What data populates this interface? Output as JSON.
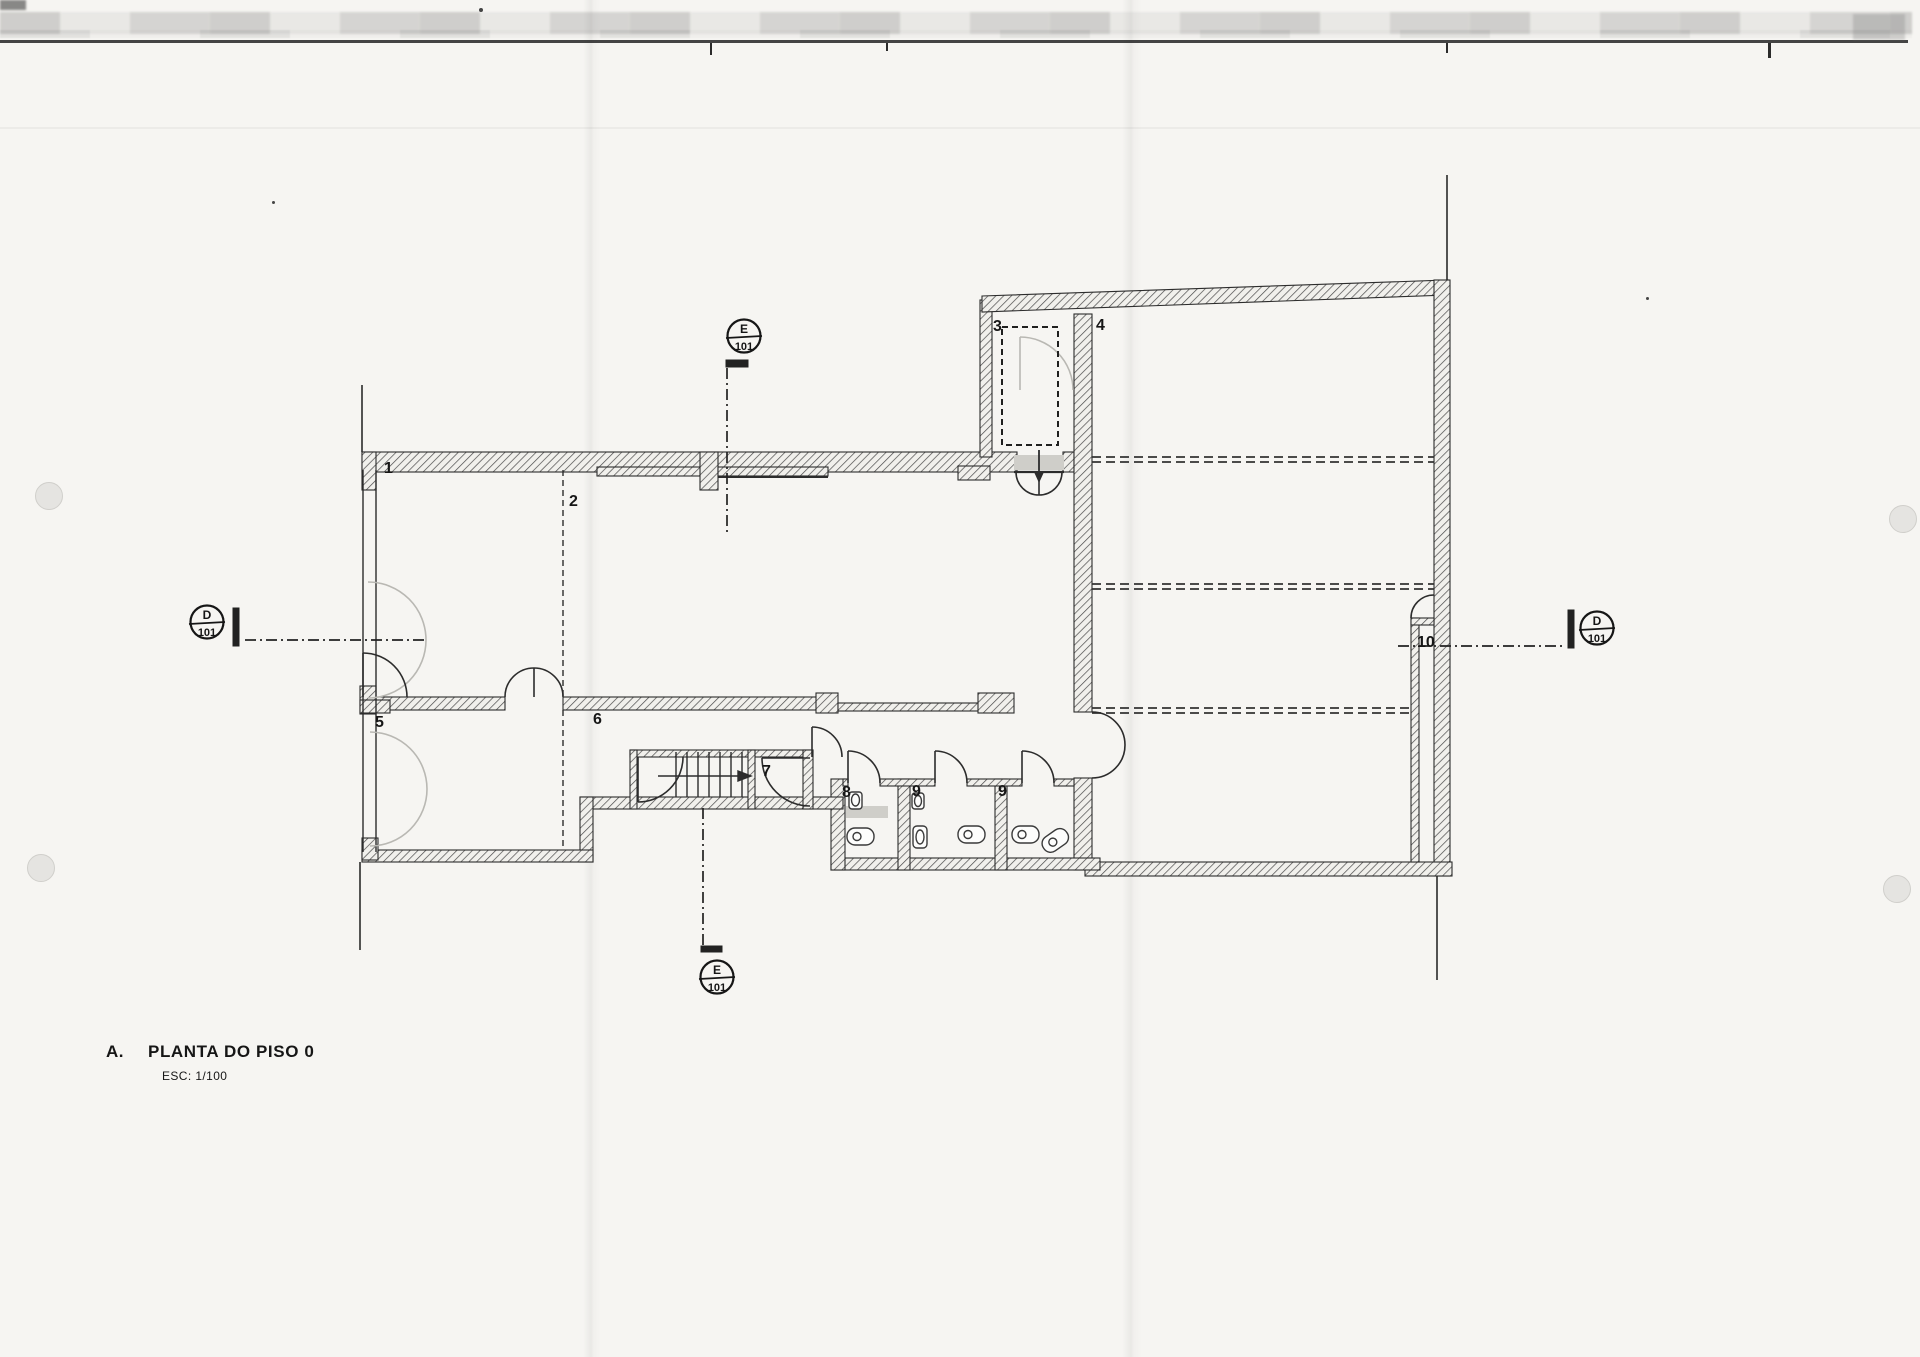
{
  "title_block": {
    "index": "A.",
    "title": "PLANTA DO PISO 0",
    "scale": "ESC: 1/100"
  },
  "rooms": [
    "1",
    "2",
    "3",
    "4",
    "5",
    "6",
    "7",
    "8",
    "9",
    "9",
    "10"
  ],
  "section_markers": [
    {
      "id": "e-top",
      "letter": "E",
      "sheet": "101"
    },
    {
      "id": "d-left",
      "letter": "D",
      "sheet": "101"
    },
    {
      "id": "d-right",
      "letter": "D",
      "sheet": "101"
    },
    {
      "id": "e-bottom",
      "letter": "E",
      "sheet": "101"
    }
  ],
  "drawing": {
    "type": "architectural-floor-plan",
    "floor": "Piso 0",
    "scale": "1/100"
  },
  "colors": {
    "paper": "#f6f5f2",
    "line": "#2b2b2b",
    "hatch": "#4a4a4a",
    "faint_gray": "#b9b8b3",
    "fixture_gray": "#cfcec9"
  }
}
